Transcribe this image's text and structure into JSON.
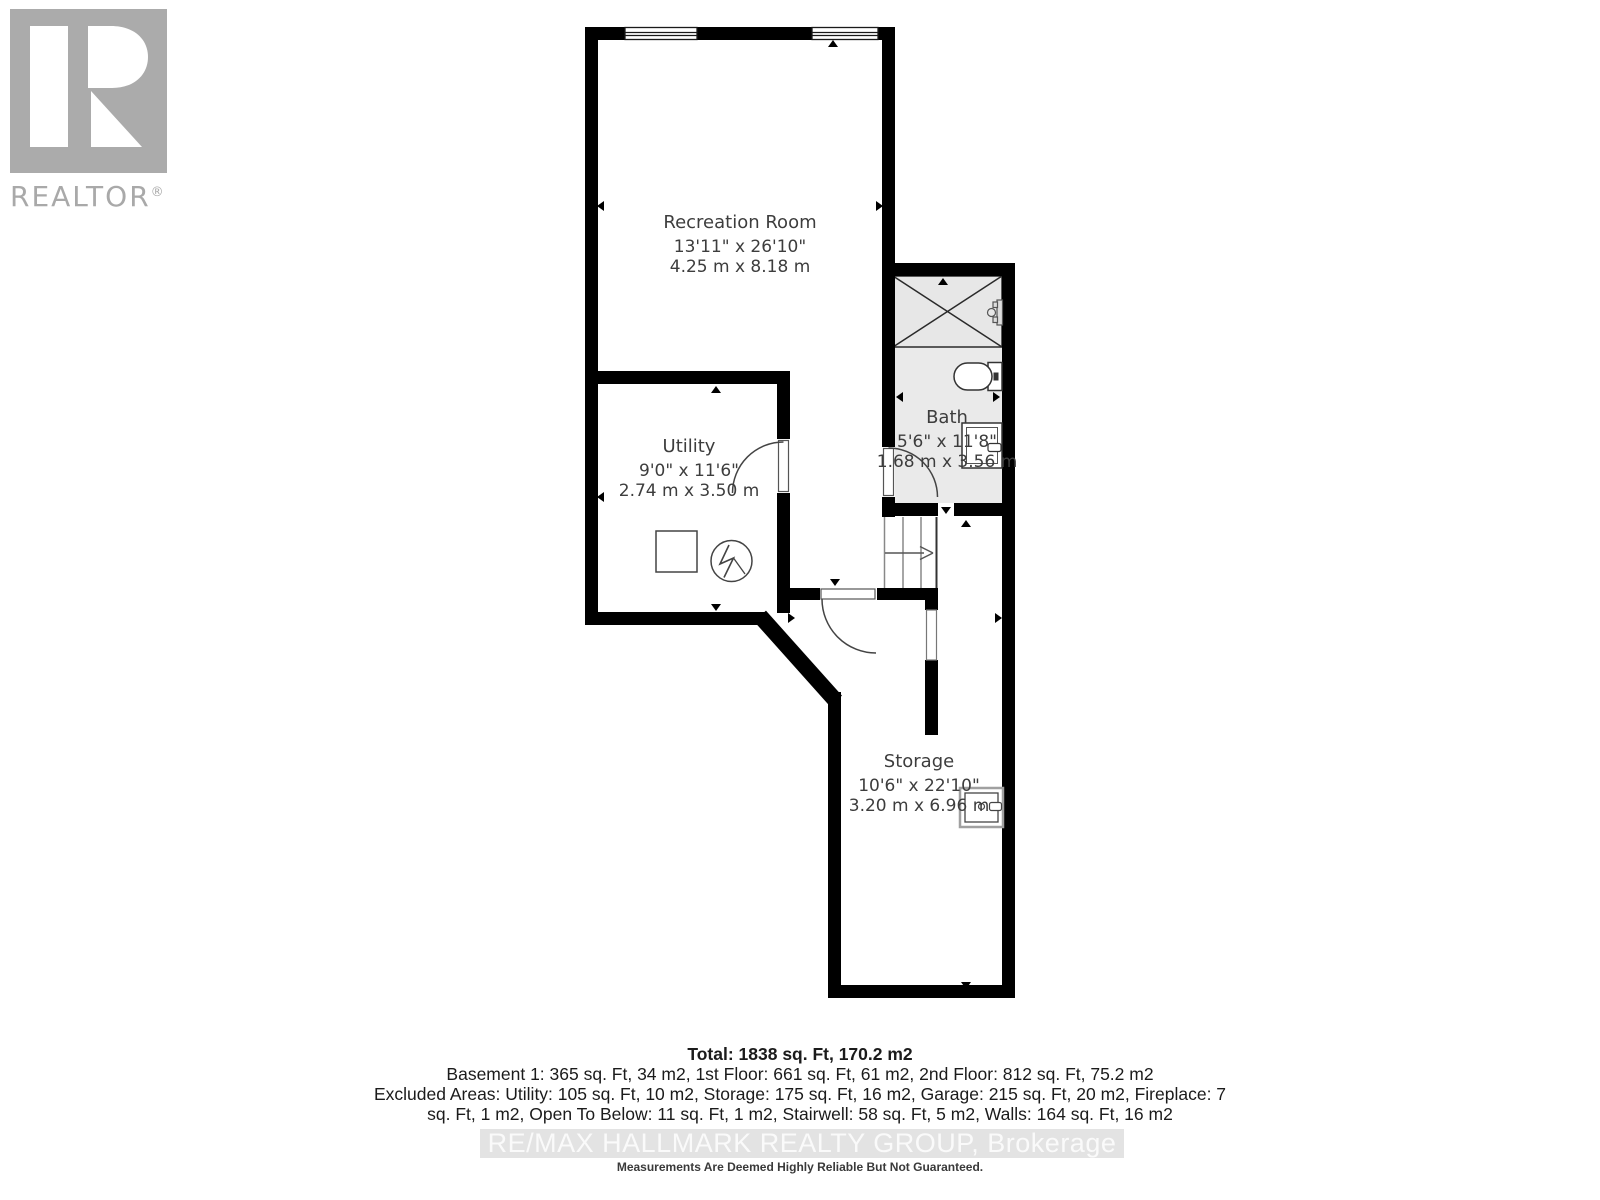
{
  "branding": {
    "logo_text": "REALTOR",
    "registered_mark": "®"
  },
  "rooms": {
    "recreation": {
      "name": "Recreation Room",
      "imperial": "13'11\" x 26'10\"",
      "metric": "4.25 m x 8.18 m"
    },
    "utility": {
      "name": "Utility",
      "imperial": "9'0\" x 11'6\"",
      "metric": "2.74 m x 3.50 m"
    },
    "bath": {
      "name": "Bath",
      "imperial": "5'6\" x 11'8\"",
      "metric": "1.68 m x 3.56 m"
    },
    "storage": {
      "name": "Storage",
      "imperial": "10'6\" x 22'10\"",
      "metric": "3.20 m x 6.96 m"
    }
  },
  "summary": {
    "total": "Total: 1838 sq. Ft, 170.2 m2",
    "floors": "Basement 1: 365 sq. Ft, 34 m2, 1st Floor: 661 sq. Ft, 61 m2, 2nd Floor: 812 sq. Ft, 75.2 m2",
    "excluded_line1": "Excluded Areas: Utility: 105 sq. Ft, 10 m2, Storage: 175 sq. Ft, 16 m2, Garage: 215 sq. Ft, 20 m2, Fireplace: 7",
    "excluded_line2": "sq. Ft, 1 m2, Open To Below: 11 sq. Ft, 1 m2, Stairwell: 58 sq. Ft, 5 m2, Walls: 164 sq. Ft, 16 m2"
  },
  "footer": {
    "watermark": "RE/MAX HALLMARK REALTY GROUP, Brokerage",
    "disclaimer": "Measurements Are Deemed Highly Reliable But Not Guaranteed."
  },
  "colors": {
    "wall": "#000000",
    "bath_fill": "#eaeaea",
    "logo_gray": "#ababab",
    "watermark_band": "#e3e3e3",
    "watermark_text": "#fafafa",
    "label_text": "#3d3d3d"
  }
}
